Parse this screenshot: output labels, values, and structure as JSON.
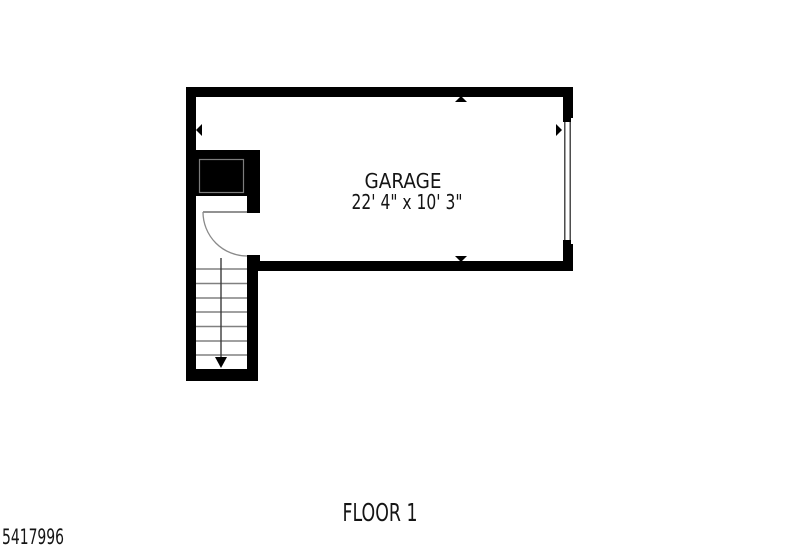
{
  "page": {
    "background": "#ffffff",
    "width": 800,
    "height": 550
  },
  "floor_plan": {
    "title": "FLOOR 1",
    "listing_id": "5417996",
    "rooms": [
      {
        "name": "GARAGE",
        "dimensions": "22' 4\" x 10' 3\""
      }
    ],
    "features": {
      "staircase": {
        "direction_icon": "down-arrow",
        "treads_visible": 8
      },
      "entry_door": {
        "type": "hinged-single",
        "swing_icon": "quarter-arc"
      },
      "garage_door": {
        "wall": "right",
        "style": "double-line-panel"
      },
      "closet": {
        "style": "solid-black-box-with-inner-outline"
      }
    },
    "dimension_markers": [
      "up-arrow",
      "down-arrow",
      "left-arrow",
      "right-arrow"
    ],
    "colors": {
      "wall": "#000000",
      "background": "#ffffff",
      "stair_tread": "#808080",
      "door_arc": "#8a8a8a",
      "text": "#151515"
    }
  }
}
